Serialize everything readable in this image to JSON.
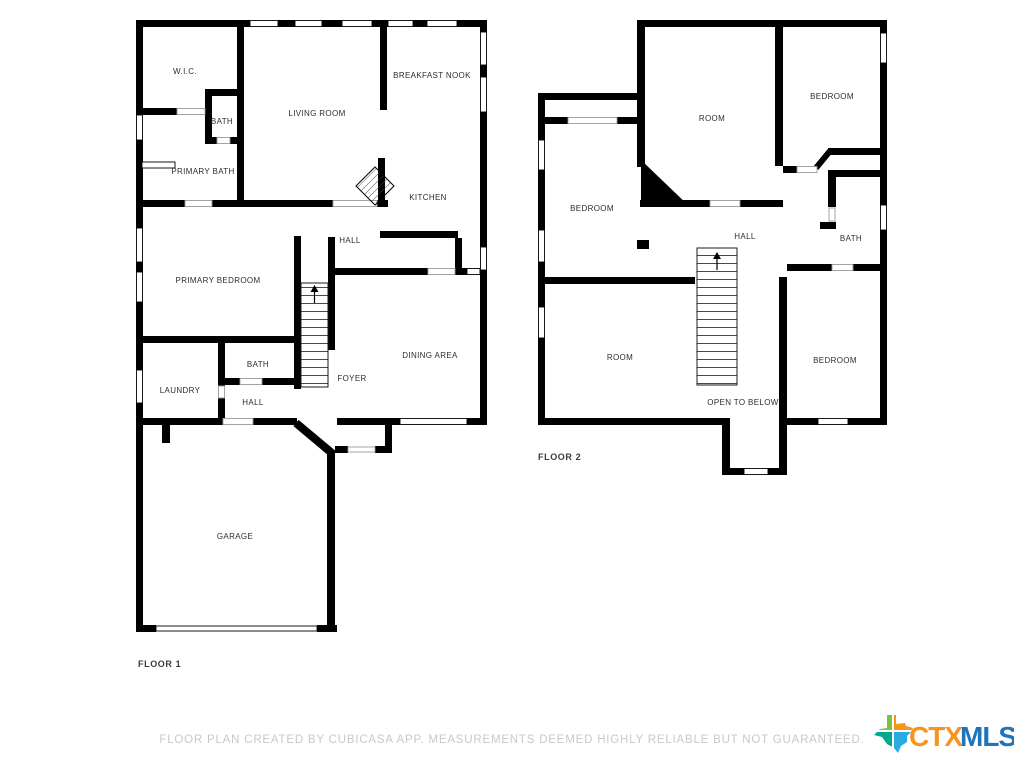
{
  "floor1": {
    "title": "FLOOR 1",
    "rooms": {
      "wic": "W.I.C.",
      "bath_upper": "BATH",
      "primary_bath": "PRIMARY BATH",
      "living_room": "LIVING ROOM",
      "breakfast_nook": "BREAKFAST NOOK",
      "kitchen": "KITCHEN",
      "hall_upper": "HALL",
      "primary_bedroom": "PRIMARY BEDROOM",
      "dining_area": "DINING AREA",
      "foyer": "FOYER",
      "bath_lower": "BATH",
      "laundry": "LAUNDRY",
      "hall_lower": "HALL",
      "garage": "GARAGE"
    }
  },
  "floor2": {
    "title": "FLOOR 2",
    "rooms": {
      "room_top": "ROOM",
      "bedroom_top_right": "BEDROOM",
      "bedroom_left": "BEDROOM",
      "hall": "HALL",
      "bath": "BATH",
      "room_lower": "ROOM",
      "bedroom_bottom_right": "BEDROOM",
      "open_to_below": "OPEN TO BELOW"
    }
  },
  "footer": {
    "disclaimer": "FLOOR PLAN CREATED BY CUBICASA APP. MEASUREMENTS DEEMED HIGHLY RELIABLE BUT NOT GUARANTEED."
  },
  "logo": {
    "ctx": "CTX",
    "mls": "MLS",
    "ctx_color": "#F7941E",
    "mls_color": "#1C75BC",
    "texas_green": "#7CC142",
    "texas_orange": "#F7941E",
    "texas_teal": "#00A88F",
    "texas_blue": "#29ABE2"
  },
  "colors": {
    "wall": "#000000",
    "room_label": "#2e2e2e",
    "disclaimer_text": "#c8c8c8"
  }
}
